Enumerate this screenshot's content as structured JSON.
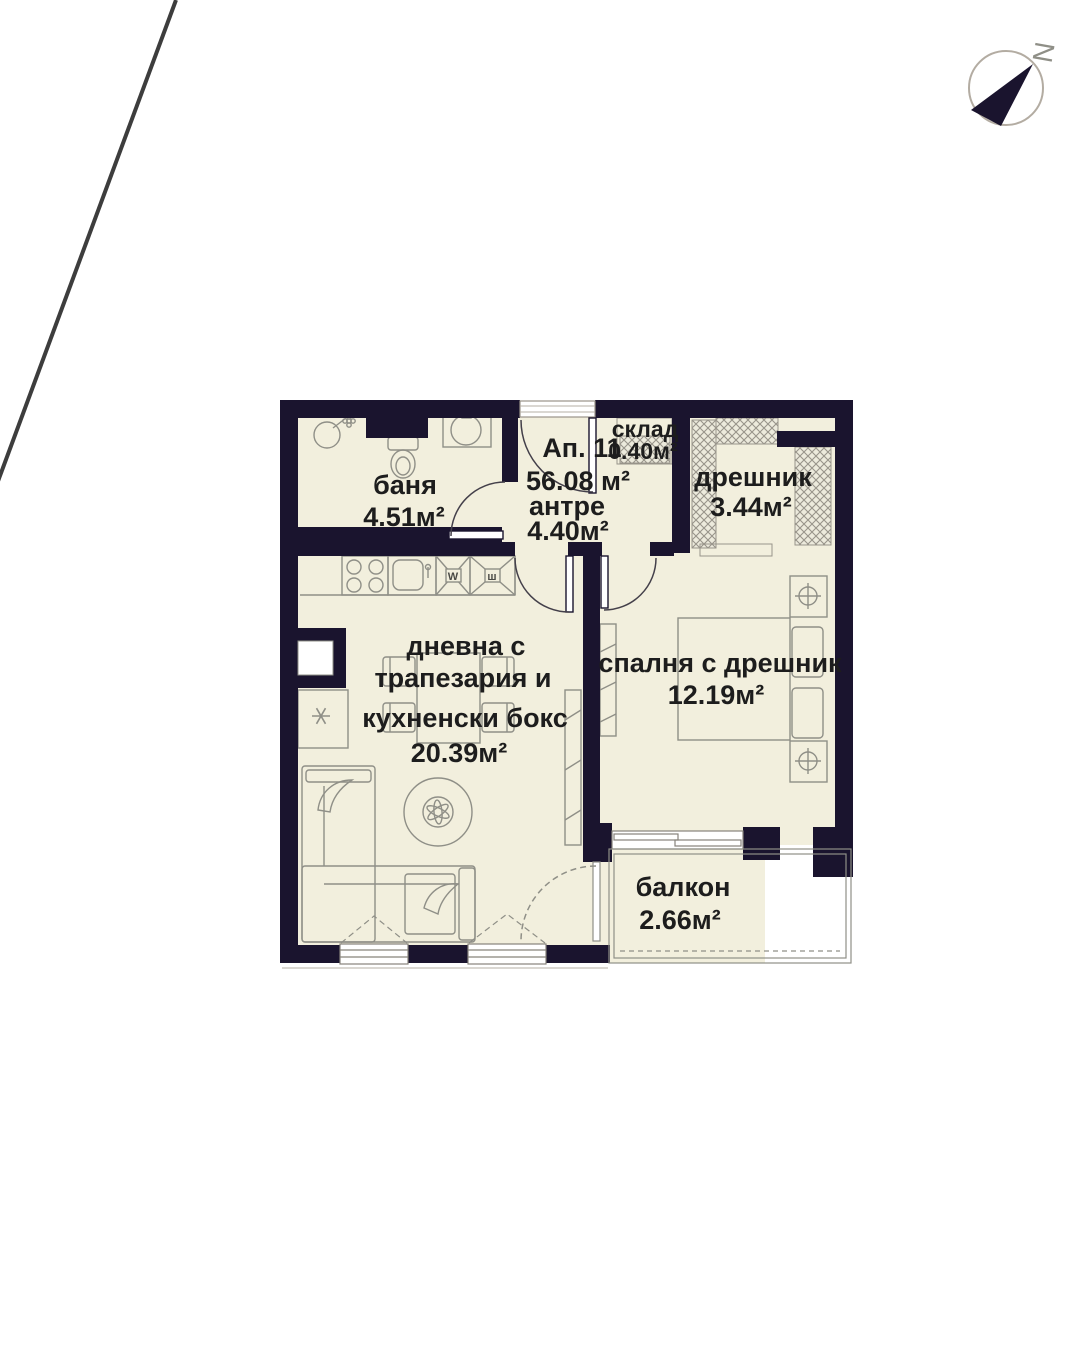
{
  "colors": {
    "wall": "#1a142e",
    "floor": "#f2efdd",
    "line": "#8f8f87",
    "text": "#1d1d1d",
    "accentline": "#3d3d3d"
  },
  "compass": {
    "letter": "N"
  },
  "apartment": {
    "number": "Ап. 11",
    "total_area": "56.08 м²"
  },
  "rooms": {
    "banya": {
      "label": "баня",
      "area": "4.51м²"
    },
    "antre": {
      "label": "антре",
      "area": "4.40м²"
    },
    "sklad": {
      "label": "склад",
      "area": "0.40м²"
    },
    "dreshnik": {
      "label": "дрешник",
      "area": "3.44м²"
    },
    "living": {
      "line1": "дневна с",
      "line2": "трапезария и",
      "line3": "кухненски бокс",
      "area": "20.39м²"
    },
    "bedroom": {
      "label": "спалня с дрешник",
      "area": "12.19м²"
    },
    "balcony": {
      "label": "балкон",
      "area": "2.66м²"
    }
  },
  "appliances": {
    "washer": "W",
    "unit2": "ш"
  }
}
